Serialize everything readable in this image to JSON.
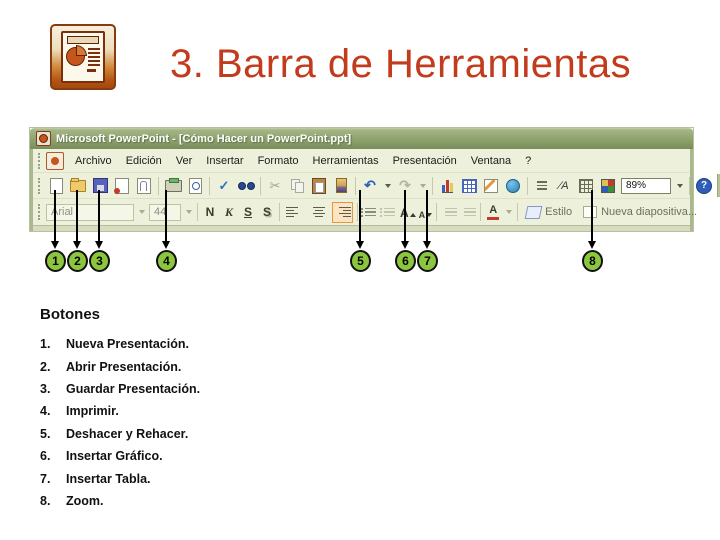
{
  "slide": {
    "title": "3. Barra de Herramientas"
  },
  "window": {
    "title": "Microsoft PowerPoint - [Cómo Hacer un PowerPoint.ppt]",
    "menu": [
      "Archivo",
      "Edición",
      "Ver",
      "Insertar",
      "Formato",
      "Herramientas",
      "Presentación",
      "Ventana",
      "?"
    ],
    "standard_toolbar": {
      "zoom_value": "89%"
    },
    "formatting_toolbar": {
      "font_name": "Arial",
      "font_size": "44",
      "bold": "N",
      "italic": "K",
      "underline": "S",
      "shadow": "S",
      "style_button": "Estilo",
      "new_slide_button": "Nueva diapositiva..."
    }
  },
  "icons": {
    "spelling": "✓",
    "cut": "✂",
    "undo": "↶",
    "redo": "↷",
    "show_formatting": "∕A",
    "help": "?",
    "font_letter": "A"
  },
  "callouts": [
    {
      "n": "1"
    },
    {
      "n": "2"
    },
    {
      "n": "3"
    },
    {
      "n": "4"
    },
    {
      "n": "5"
    },
    {
      "n": "6"
    },
    {
      "n": "7"
    },
    {
      "n": "8"
    }
  ],
  "legend": {
    "heading": "Botones",
    "items": [
      {
        "num": "1.",
        "text": "Nueva Presentación."
      },
      {
        "num": "2.",
        "text": "Abrir Presentación."
      },
      {
        "num": "3.",
        "text": "Guardar Presentación."
      },
      {
        "num": "4.",
        "text": "Imprimir."
      },
      {
        "num": "5.",
        "text": "Deshacer y Rehacer."
      },
      {
        "num": "6.",
        "text": "Insertar Gráfico."
      },
      {
        "num": "7.",
        "text": "Insertar Tabla."
      },
      {
        "num": "8.",
        "text": "Zoom."
      }
    ]
  },
  "colors": {
    "title_red": "#c23b1c",
    "titlebar_olive": "#92a673",
    "toolbar_bg": "#edf0da",
    "callout_green": "#8cc63f"
  }
}
